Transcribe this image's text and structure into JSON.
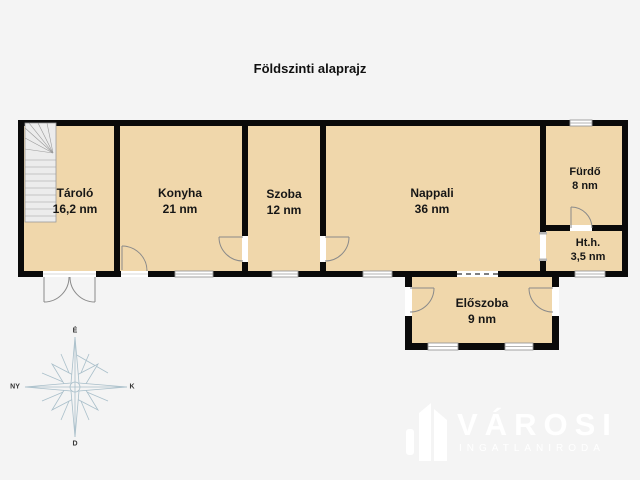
{
  "title": "Földszinti alaprajz",
  "floor_plan": {
    "rooms": [
      {
        "name": "Tároló",
        "area": "16,2 nm"
      },
      {
        "name": "Konyha",
        "area": "21 nm"
      },
      {
        "name": "Szoba",
        "area": "12 nm"
      },
      {
        "name": "Nappali",
        "area": "36 nm"
      },
      {
        "name": "Fürdő",
        "area": "8 nm"
      },
      {
        "name": "Ht.h.",
        "area": "3,5 nm"
      },
      {
        "name": "Előszoba",
        "area": "9 nm"
      }
    ],
    "compass": {
      "north": "É",
      "south": "D",
      "east": "K",
      "west": "NY"
    }
  },
  "watermark": {
    "brand": "VÁROSI",
    "subtitle": "INGATLANIRODA"
  },
  "colors": {
    "background": "#f4f4f4",
    "floor": "#f0d7ab",
    "wall": "#0a0a0a",
    "compass": "#a9bfca",
    "logo": "#ffffff"
  }
}
